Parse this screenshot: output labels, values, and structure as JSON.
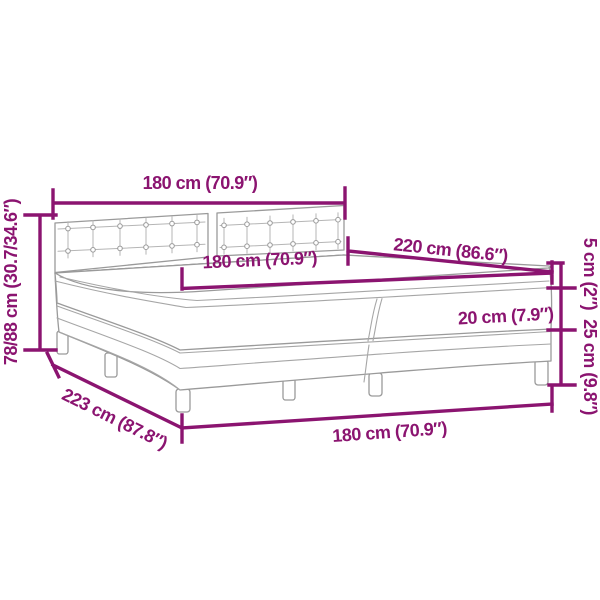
{
  "diagram": {
    "type": "product-dimension-diagram",
    "subject": "box spring bed with tufted headboard, split mattress and topper",
    "accent_color": "#8B1470",
    "structure_line_color": "#9a9a9a",
    "background_color": "#ffffff",
    "dimensions": {
      "headboard_width": "180 cm (70.9″)",
      "mattress_length": "220 cm (86.6″)",
      "mattress_width": "180 cm (70.9″)",
      "total_height": "78/88 cm (30.7/34.6″)",
      "topper_height": "5 cm (2″)",
      "mattress_height": "20 cm (7.9″)",
      "base_height": "25 cm (9.8″)",
      "total_length": "223 cm (87.8″)",
      "base_width": "180 cm (70.9″)"
    }
  }
}
